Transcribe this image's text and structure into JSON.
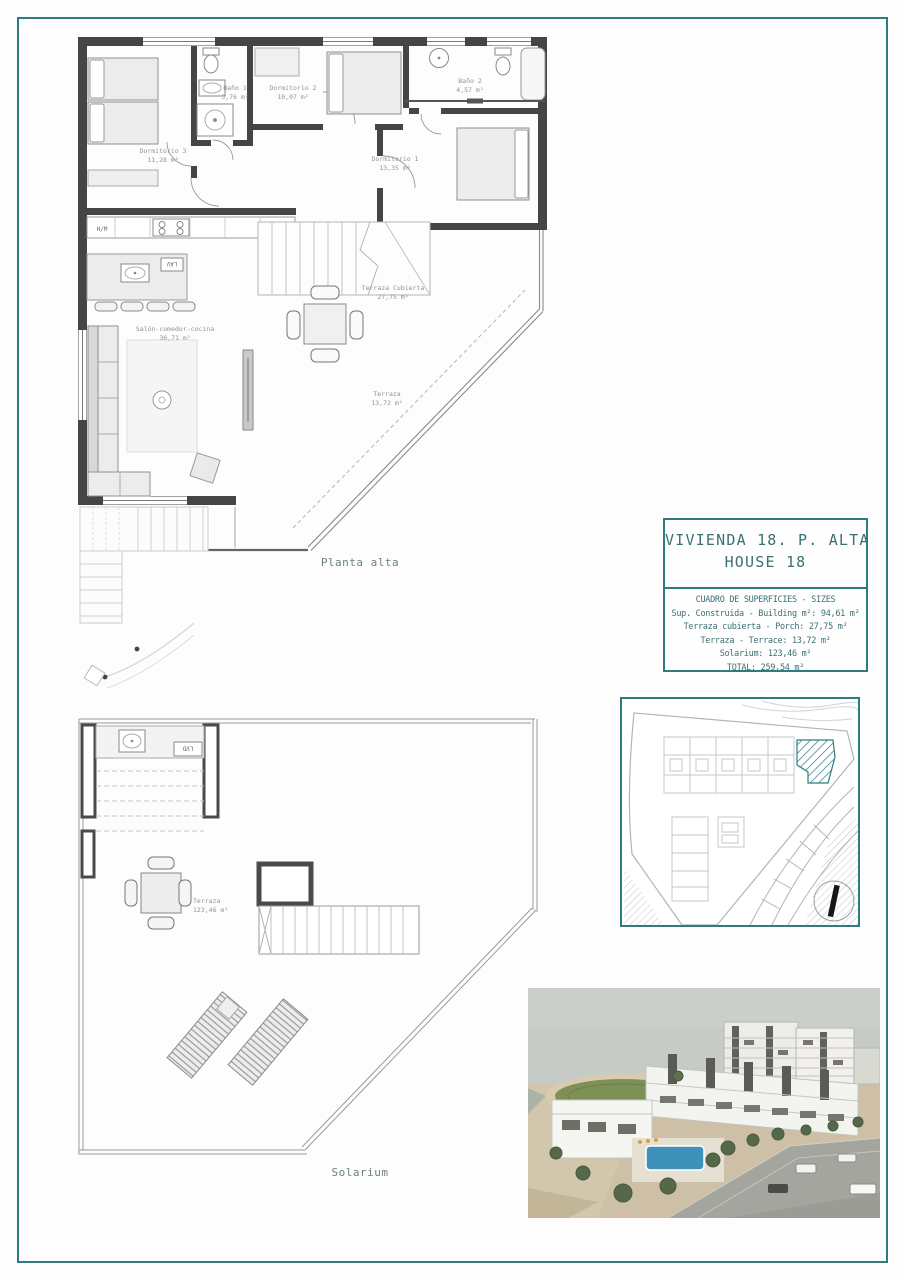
{
  "colors": {
    "accent_teal": "#2e7c80",
    "wall_dark": "#454545",
    "plan_label_gray": "#8f9494",
    "title_text_teal": "#3c7073"
  },
  "upper_plan": {
    "caption": "Planta alta",
    "labels": {
      "dormitorio3": {
        "name": "Dormitorio 3",
        "area": "11,28 m²"
      },
      "bano1": {
        "name": "Baño 1",
        "area": "3,76 m²"
      },
      "dormitorio2": {
        "name": "Dormitorio 2",
        "area": "10,07 m²"
      },
      "bano2": {
        "name": "Baño 2",
        "area": "4,57 m²"
      },
      "dormitorio1": {
        "name": "Dormitorio 1",
        "area": "13,35 m²"
      },
      "salon": {
        "name": "Salón-comedor-cocina",
        "area": "36,71 m²"
      },
      "terraza_cubierta": {
        "name": "Terraza Cubierta",
        "area": "27,75 m²"
      },
      "terraza": {
        "name": "Terraza",
        "area": "13,72 m²"
      }
    },
    "appliances": {
      "washer": "H/M",
      "fridge": "F",
      "dishwasher": "LAV"
    }
  },
  "solarium_plan": {
    "caption": "Solarium",
    "labels": {
      "terraza": {
        "name": "Terraza",
        "area": "123,46 m²"
      }
    },
    "appliances": {
      "dishwasher": "LVD"
    }
  },
  "title_block": {
    "title_line1": "VIVIENDA 18. P. ALTA",
    "title_line2": "HOUSE 18",
    "surfaces_header": "CUADRO DE SUPERFICIES - SIZES",
    "surfaces": [
      "Sup. Construida - Building m²: 94,61 m²",
      "Terraza cubierta - Porch: 27,75 m²",
      "Terraza - Terrace: 13,72 m²",
      "Solarium: 123,46 m²",
      "TOTAL: 259,54 m²"
    ]
  }
}
